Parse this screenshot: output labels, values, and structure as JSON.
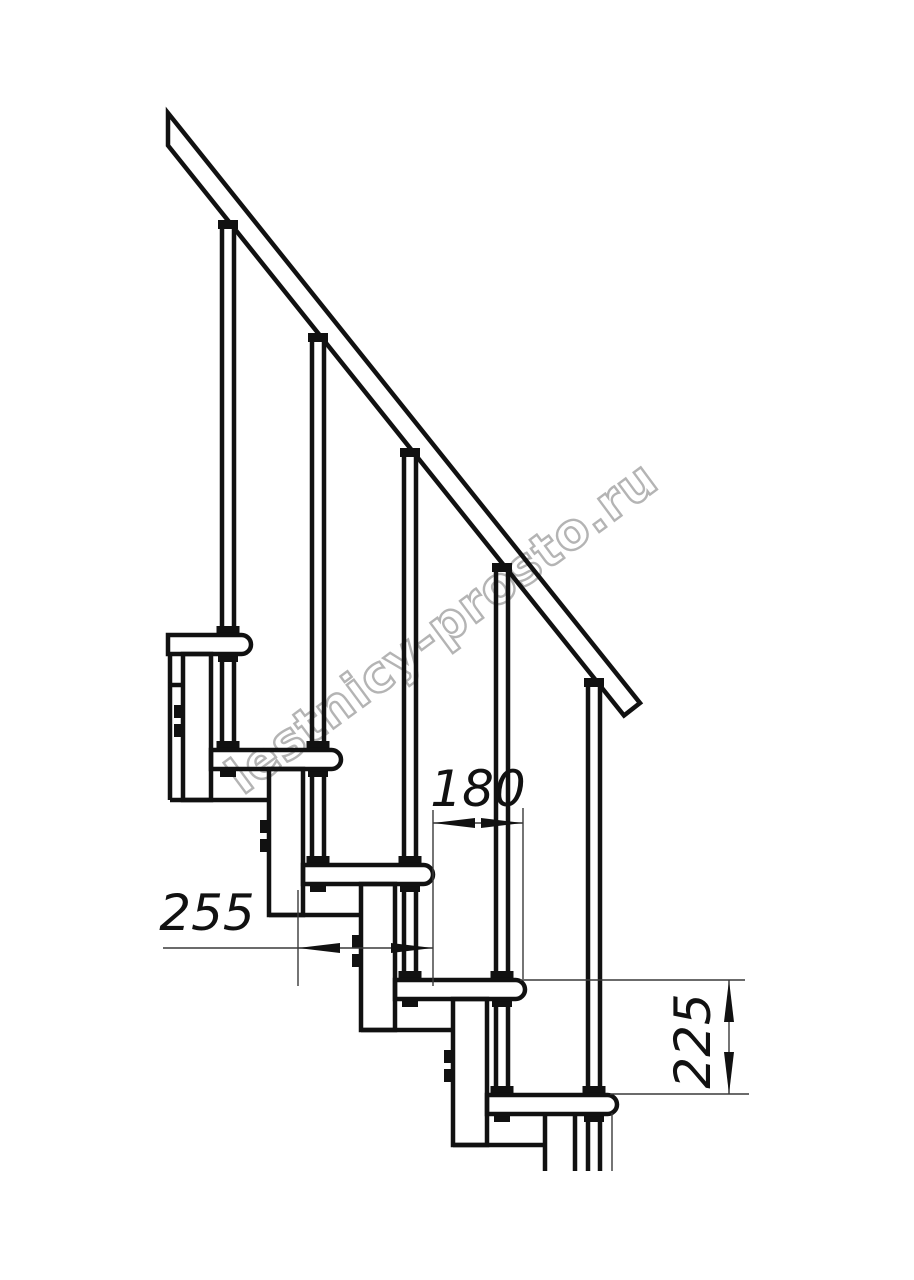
{
  "canvas": {
    "width": 914,
    "height": 1280,
    "background": "#ffffff",
    "ink": "#111111",
    "thin_line_color": "#3a3a3a"
  },
  "watermark": {
    "text": "lestnicy-prosto.ru",
    "color": "#b4b4b4"
  },
  "structure": {
    "steps_visible": 5,
    "balusters_visible": 5,
    "handrail": true,
    "support_columns_visible": 5
  },
  "dimensions": {
    "d255": {
      "value": "255",
      "orientation": "horizontal"
    },
    "d180": {
      "value": "180",
      "orientation": "horizontal"
    },
    "d225": {
      "value": "225",
      "orientation": "vertical"
    }
  }
}
